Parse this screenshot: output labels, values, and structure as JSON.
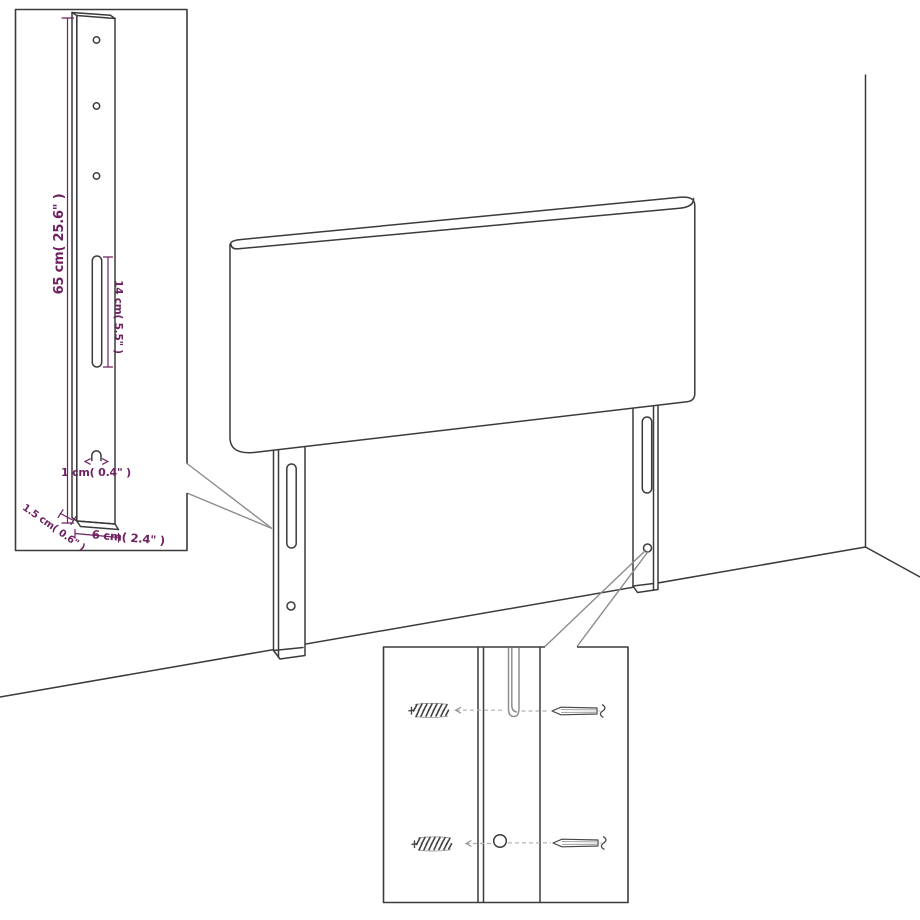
{
  "diagram": {
    "kind": "furniture-dimension-diagram",
    "background": "#ffffff",
    "line_color": "#3b3b3b",
    "callout_color": "#8c8c8c",
    "dimension_text_color": "#6e2260",
    "main_view": {
      "subject": "headboard-with-two-mounting-legs",
      "legs": 2,
      "slots_per_leg": 1,
      "holes_per_leg": 1
    },
    "insets": {
      "bracket_detail": {
        "hole_count": 3,
        "dim_height": "65 cm( 25.6\" )",
        "dim_slot_length": "14 cm( 5.5\" )",
        "dim_hole": "1 cm( 0.4\" )",
        "dim_thickness": "1.5 cm( 0.6\" )",
        "dim_width": "6 cm( 2.4\" )"
      },
      "mounting_detail": {
        "icons": [
          "wall-plug-icon",
          "screw-icon",
          "slot-closeup",
          "hole-closeup"
        ],
        "wall_plug_count": 2,
        "screw_count": 2
      }
    }
  }
}
